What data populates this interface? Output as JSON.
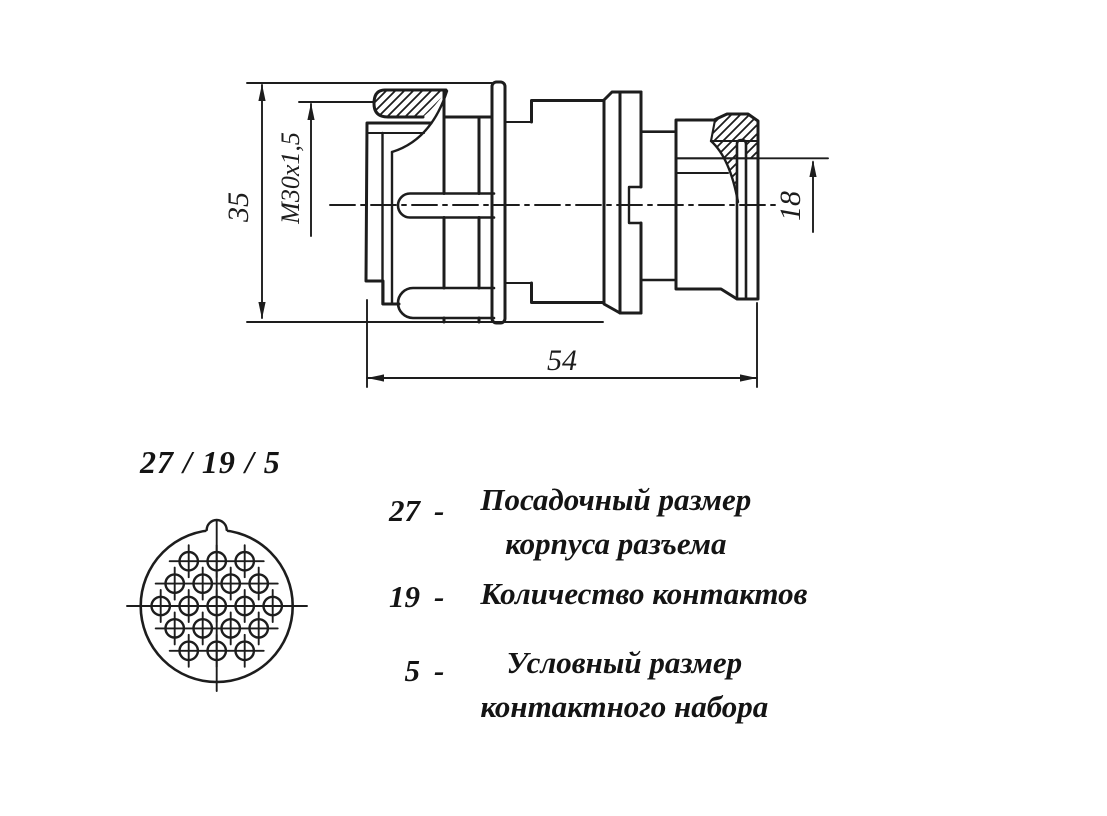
{
  "canvas": {
    "background": "#ffffff",
    "ink": "#1d1d1d"
  },
  "drawing": {
    "description": "connector side section view",
    "dimensions": {
      "body_height": "35",
      "thread": "M30x1,5",
      "cable_entry": "18",
      "length": "54"
    }
  },
  "face_view": {
    "designation": "27 / 19 / 5",
    "pin_rows": [
      3,
      4,
      5,
      4,
      3
    ],
    "total_contacts": 19
  },
  "legend": {
    "items": [
      {
        "value": "27",
        "dash": "-",
        "lines": [
          "Посадочный размер",
          "корпуса разъема"
        ]
      },
      {
        "value": "19",
        "dash": "-",
        "lines": [
          "Количество контактов"
        ]
      },
      {
        "value": "5",
        "dash": "-",
        "lines": [
          "Условный размер",
          "контактного набора"
        ]
      }
    ]
  }
}
